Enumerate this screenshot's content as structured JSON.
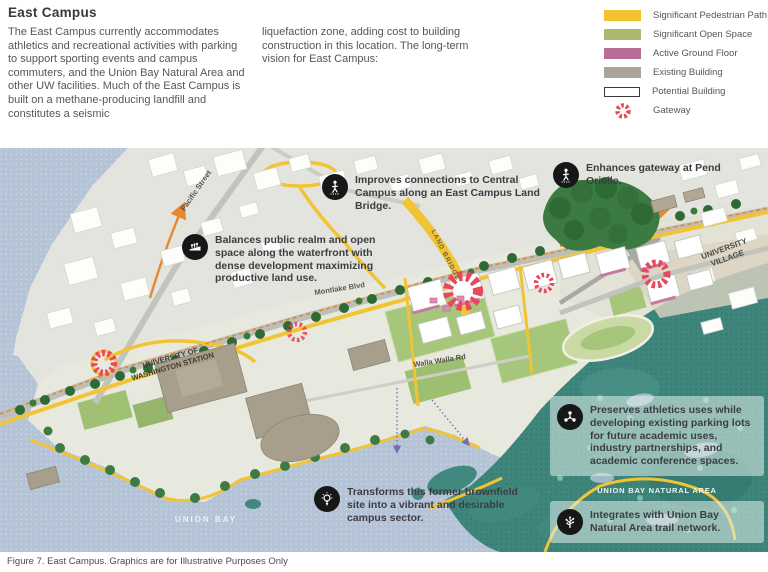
{
  "page": {
    "title": "East Campus",
    "intro_col1": "The East Campus currently accommodates athletics and recreational activities with parking to support sporting events and campus commuters, and the Union Bay Natural Area and other UW facilities. Much of the East Campus is built on a methane-producing landfill and constitutes a seismic",
    "intro_col2": "liquefaction zone, adding cost to building construction in this location. The long-term vision for East Campus:",
    "caption": "Figure 7. East Campus. Graphics are for Illustrative Purposes Only"
  },
  "legend": {
    "items": [
      {
        "label": "Significant Pedestrian Path",
        "color": "#F2C12E",
        "style": "swatch"
      },
      {
        "label": "Significant Open Space",
        "color": "#A9BA6E",
        "style": "swatch"
      },
      {
        "label": "Active Ground Floor",
        "color": "#B76E96",
        "style": "swatch"
      },
      {
        "label": "Existing Building",
        "color": "#ABA49B",
        "style": "swatch"
      },
      {
        "label": "Potential Building",
        "color": "#FFFFFF",
        "style": "swatch-outline"
      },
      {
        "label": "Gateway",
        "color": "#E8485C",
        "style": "gateway-icon"
      }
    ]
  },
  "map": {
    "annotations": [
      {
        "icon": "pedestrian-icon",
        "text": "Improves connections to Central Campus along an East Campus Land Bridge."
      },
      {
        "icon": "waterfront-icon",
        "text": "Balances public realm and open space along the waterfront with dense development maximizing productive land use."
      },
      {
        "icon": "pedestrian-icon",
        "text": "Enhances gateway at Pend Orielle."
      },
      {
        "icon": "network-icon",
        "text": "Preserves athletics uses while developing existing parking lots for future academic uses, industry partnerships, and academic conference spaces."
      },
      {
        "icon": "lightbulb-icon",
        "text": "Transforms this former brownfield site into a vibrant and desirable campus sector."
      },
      {
        "icon": "tree-icon",
        "text": "Integrates with Union Bay Natural Area trail network."
      }
    ],
    "labels": {
      "pacific_street": "Pacific Street",
      "montlake_blvd": "Montlake Blvd",
      "land_bridge": "LAND BRIDGE",
      "walla_walla_rd": "Walla Walla Rd",
      "uw_station_line1": "UNIVERSITY OF",
      "uw_station_line2": "WASHINGTON STATION",
      "university_village_line1": "UNIVERSITY",
      "university_village_line2": "VILLAGE",
      "union_bay": "UNION BAY",
      "union_bay_natural_area": "UNION BAY NATURAL AREA"
    }
  }
}
